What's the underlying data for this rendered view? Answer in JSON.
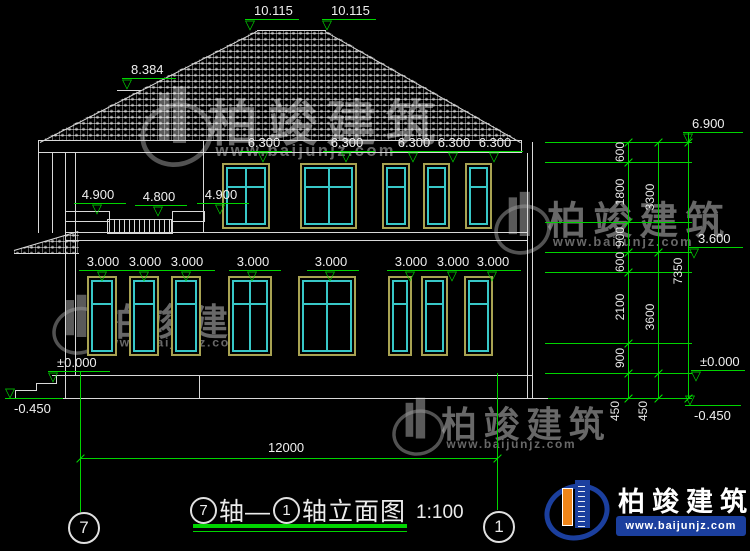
{
  "title": {
    "axis_a": "7",
    "mid": "轴—",
    "axis_b": "1",
    "suffix": "轴立面图",
    "scale": "1:100"
  },
  "axis_bubbles": {
    "left": "7",
    "right": "1"
  },
  "brand": {
    "name": "柏竣建筑",
    "url": "www.baijunjz.com"
  },
  "watermark": {
    "name": "柏竣建筑",
    "url": "www.baijunjz.com"
  },
  "hdim": {
    "t": "12000"
  },
  "colors": {
    "bg": "#000000",
    "line": "#d9d9d9",
    "dim_green": "#00d400",
    "window_frame": "#a8a352",
    "window_glass": "#38c8c8",
    "logo_blue": "#1b3f9e",
    "logo_orange": "#f08519"
  },
  "levels": [
    {
      "t": "10.115",
      "x": 250,
      "y": 19,
      "mode": "left"
    },
    {
      "t": "10.115",
      "x": 327,
      "y": 19,
      "mode": "left"
    },
    {
      "t": "8.384",
      "x": 127,
      "y": 78,
      "mode": "left"
    },
    {
      "t": "6.300",
      "x": 263,
      "y": 151,
      "mode": "center"
    },
    {
      "t": "6.300",
      "x": 346,
      "y": 151,
      "mode": "center"
    },
    {
      "t": "6.300",
      "x": 413,
      "y": 151,
      "mode": "center"
    },
    {
      "t": "6.300",
      "x": 453,
      "y": 151,
      "mode": "center"
    },
    {
      "t": "6.300",
      "x": 494,
      "y": 151,
      "mode": "center"
    },
    {
      "t": "4.900",
      "x": 97,
      "y": 203,
      "mode": "center"
    },
    {
      "t": "4.800",
      "x": 158,
      "y": 205,
      "mode": "center"
    },
    {
      "t": "4.900",
      "x": 220,
      "y": 203,
      "mode": "center"
    },
    {
      "t": "3.000",
      "x": 102,
      "y": 270,
      "mode": "center"
    },
    {
      "t": "3.000",
      "x": 144,
      "y": 270,
      "mode": "center"
    },
    {
      "t": "3.000",
      "x": 186,
      "y": 270,
      "mode": "center"
    },
    {
      "t": "3.000",
      "x": 252,
      "y": 270,
      "mode": "center"
    },
    {
      "t": "3.000",
      "x": 330,
      "y": 270,
      "mode": "center"
    },
    {
      "t": "3.000",
      "x": 410,
      "y": 270,
      "mode": "center"
    },
    {
      "t": "3.000",
      "x": 452,
      "y": 270,
      "mode": "center"
    },
    {
      "t": "3.000",
      "x": 492,
      "y": 270,
      "mode": "center"
    },
    {
      "t": "±0.000",
      "x": 53,
      "y": 371,
      "mode": "left",
      "w": 56
    },
    {
      "t": "-0.450",
      "x": 10,
      "y": 398,
      "mode": "left",
      "flip": true,
      "w": 52
    },
    {
      "t": "6.900",
      "x": 688,
      "y": 132,
      "mode": "left",
      "w": 54
    },
    {
      "t": "3.600",
      "x": 694,
      "y": 247,
      "mode": "left",
      "w": 48
    },
    {
      "t": "±0.000",
      "x": 696,
      "y": 370,
      "mode": "left",
      "w": 48
    },
    {
      "t": "-0.450",
      "x": 690,
      "y": 405,
      "mode": "left",
      "flip": true,
      "w": 50
    }
  ],
  "vdim_texts": [
    {
      "t": "600",
      "x": 620,
      "y": 152
    },
    {
      "t": "1800",
      "x": 620,
      "y": 192
    },
    {
      "t": "900",
      "x": 620,
      "y": 237
    },
    {
      "t": "600",
      "x": 620,
      "y": 262
    },
    {
      "t": "2100",
      "x": 620,
      "y": 307
    },
    {
      "t": "900",
      "x": 620,
      "y": 358
    },
    {
      "t": "450",
      "x": 615,
      "y": 411
    },
    {
      "t": "3300",
      "x": 650,
      "y": 197
    },
    {
      "t": "3600",
      "x": 650,
      "y": 317
    },
    {
      "t": "450",
      "x": 643,
      "y": 411
    },
    {
      "t": "7350",
      "x": 678,
      "y": 271
    }
  ],
  "layout": {
    "wlines": [
      [
        38,
        140,
        484,
        1
      ],
      [
        38,
        152,
        484,
        1
      ],
      [
        38,
        140,
        1,
        13
      ],
      [
        521,
        140,
        1,
        13
      ],
      [
        203,
        140,
        1,
        13
      ],
      [
        257,
        30,
        69,
        1
      ],
      [
        65,
        153,
        1,
        245
      ],
      [
        75,
        153,
        1,
        222
      ],
      [
        38,
        153,
        1,
        80
      ],
      [
        52,
        153,
        1,
        80
      ],
      [
        203,
        153,
        1,
        80
      ],
      [
        65,
        232,
        463,
        1
      ],
      [
        65,
        240,
        463,
        1
      ],
      [
        527,
        153,
        1,
        245
      ],
      [
        532,
        142,
        1,
        256
      ],
      [
        52,
        375,
        480,
        1
      ],
      [
        14,
        398,
        534,
        1
      ],
      [
        199,
        375,
        1,
        23
      ],
      [
        14,
        253,
        65,
        1
      ],
      [
        117,
        90,
        24,
        1
      ],
      [
        15,
        390,
        1,
        9
      ],
      [
        15,
        390,
        22,
        1
      ],
      [
        36,
        383,
        1,
        8
      ],
      [
        36,
        383,
        21,
        1
      ],
      [
        56,
        375,
        1,
        9
      ]
    ],
    "rlines": [
      [
        40,
        142,
        244,
        -27.1
      ],
      [
        325,
        31,
        225,
        29.6
      ],
      [
        14,
        250,
        67,
        -16.5
      ]
    ],
    "caps": [
      [
        65,
        211,
        43,
        9
      ],
      [
        172,
        211,
        31,
        9
      ]
    ],
    "rail": [
      107,
      219,
      66,
      15
    ],
    "roof": {
      "x": 38,
      "y": 29,
      "w": 484,
      "h": 113,
      "clip": "polygon(2px 112px, 219px 1px, 287px 1px, 482px 112px)"
    },
    "canopy": {
      "x": 14,
      "y": 231,
      "w": 65,
      "h": 23,
      "clip": "polygon(0 19px, 65px 0, 65px 22px, 0 23px)"
    },
    "windows": [
      {
        "x": 222,
        "y": 163,
        "w": 48,
        "h": 66,
        "cross": true
      },
      {
        "x": 300,
        "y": 163,
        "w": 57,
        "h": 66,
        "cross": true
      },
      {
        "x": 382,
        "y": 163,
        "w": 28,
        "h": 66
      },
      {
        "x": 423,
        "y": 163,
        "w": 27,
        "h": 66
      },
      {
        "x": 465,
        "y": 163,
        "w": 27,
        "h": 66
      },
      {
        "x": 87,
        "y": 276,
        "w": 30,
        "h": 80
      },
      {
        "x": 129,
        "y": 276,
        "w": 30,
        "h": 80
      },
      {
        "x": 171,
        "y": 276,
        "w": 30,
        "h": 80
      },
      {
        "x": 228,
        "y": 276,
        "w": 44,
        "h": 80,
        "cross": true
      },
      {
        "x": 298,
        "y": 276,
        "w": 58,
        "h": 80,
        "cross": true
      },
      {
        "x": 388,
        "y": 276,
        "w": 24,
        "h": 80
      },
      {
        "x": 421,
        "y": 276,
        "w": 27,
        "h": 80
      },
      {
        "x": 464,
        "y": 276,
        "w": 29,
        "h": 80
      }
    ],
    "dim_vlines": [
      {
        "x": 628,
        "y1": 142,
        "y2": 398,
        "ticks": [
          142,
          162,
          222,
          252,
          272,
          343,
          373,
          398
        ]
      },
      {
        "x": 658,
        "y1": 142,
        "y2": 398,
        "ticks": [
          142,
          252,
          373,
          398
        ]
      },
      {
        "x": 688,
        "y1": 132,
        "y2": 398,
        "ticks": [
          142,
          398
        ]
      }
    ],
    "ext_lines": [
      {
        "x1": 545,
        "x2": 692,
        "ys": [
          142,
          162,
          222,
          252,
          272,
          343,
          373
        ]
      },
      {
        "x1": 548,
        "x2": 692,
        "ys": [
          398
        ]
      }
    ],
    "green_vlines": [
      {
        "x": 80,
        "y1": 371,
        "y2": 512
      },
      {
        "x": 497,
        "y1": 373,
        "y2": 510
      }
    ],
    "hdim_line": {
      "x1": 80,
      "x2": 497,
      "y": 458
    },
    "watermarks": [
      {
        "x": 140,
        "y": 84,
        "s": 1.18
      },
      {
        "x": 52,
        "y": 293,
        "s": 0.88
      },
      {
        "x": 494,
        "y": 190,
        "s": 0.92
      },
      {
        "x": 392,
        "y": 396,
        "s": 0.85
      }
    ]
  }
}
